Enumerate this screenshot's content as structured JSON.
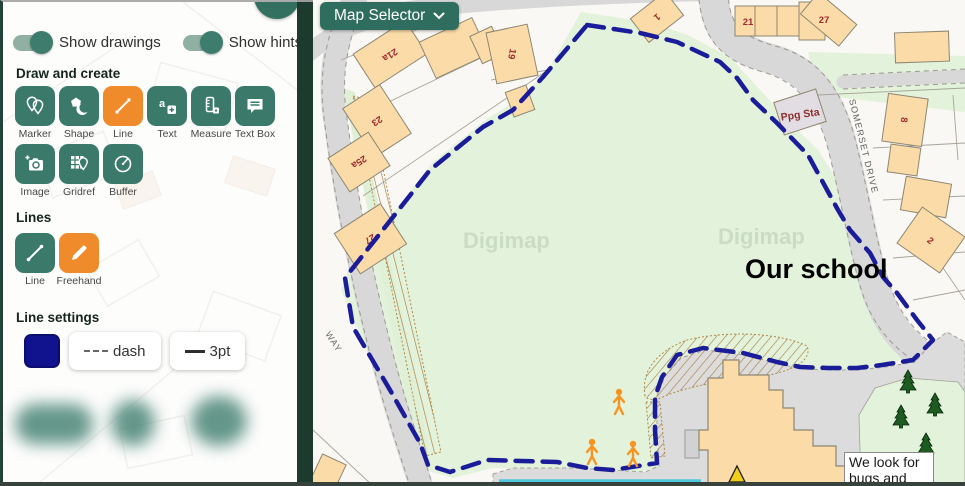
{
  "sidebar": {
    "toggles": [
      {
        "label": "Show drawings",
        "state": "on"
      },
      {
        "label": "Show hints",
        "state": "on"
      }
    ],
    "sections": {
      "draw": {
        "title": "Draw and create"
      },
      "lines": {
        "title": "Lines"
      },
      "line_settings": {
        "title": "Line settings"
      }
    },
    "draw_tools": [
      {
        "label": "Marker",
        "icon": "marker-icon",
        "active": false
      },
      {
        "label": "Shape",
        "icon": "shape-icon",
        "active": false
      },
      {
        "label": "Line",
        "icon": "line-icon",
        "active": true
      },
      {
        "label": "Text",
        "icon": "text-icon",
        "active": false
      },
      {
        "label": "Measure",
        "icon": "measure-icon",
        "active": false
      },
      {
        "label": "Text Box",
        "icon": "text-box-icon",
        "active": false
      },
      {
        "label": "Image",
        "icon": "image-icon",
        "active": false
      },
      {
        "label": "Gridref",
        "icon": "gridref-icon",
        "active": false
      },
      {
        "label": "Buffer",
        "icon": "buffer-icon",
        "active": false
      }
    ],
    "line_tools": [
      {
        "label": "Line",
        "icon": "line-segment-icon",
        "active": false
      },
      {
        "label": "Freehand",
        "icon": "freehand-icon",
        "active": true
      }
    ],
    "line_settings": {
      "color": "#10128E",
      "style_label": "dash",
      "width_label": "3pt"
    }
  },
  "map": {
    "selector_label": "Map Selector",
    "watermark": "Digimap",
    "school_label": "Our school",
    "textbox": {
      "line1": "We look for",
      "line2": "bugs and"
    },
    "ppg_sta_label": "Ppg Sta",
    "streets": {
      "somerset": "SOMERSET DRIVE",
      "way": "WAY"
    },
    "numbers": {
      "n21a": "21a",
      "n23": "23",
      "n25a": "25a",
      "n27w": "27",
      "n19": "19",
      "n1": "1",
      "n21": "21",
      "n27e": "27",
      "n8": "8",
      "n2": "2"
    },
    "colors": {
      "boundary": "#1A1C99",
      "field": "#E3F2DA",
      "building": "#FBDCA9",
      "accent_teal": "#3B7A6B",
      "accent_orange": "#F08B2B",
      "person": "#F79421",
      "tree": "#1E5B21",
      "water_line": "#4FC8DC"
    }
  }
}
